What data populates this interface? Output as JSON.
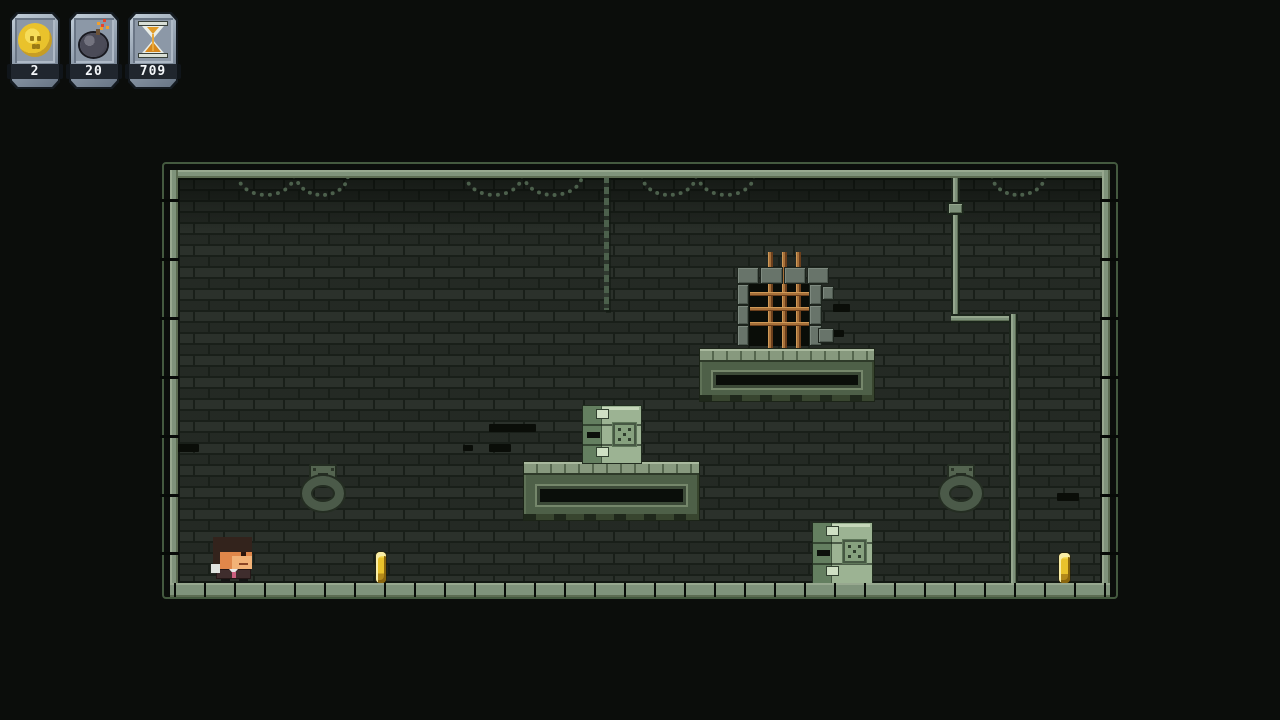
{
  "hud": {
    "counters": [
      {
        "id": "coins",
        "icon": "coin-icon",
        "value": "2"
      },
      {
        "id": "bombs",
        "icon": "bomb-icon",
        "value": "20"
      },
      {
        "id": "timer",
        "icon": "hourglass-icon",
        "value": "709"
      }
    ]
  },
  "colors": {
    "frame-green": "#44593f",
    "band-green": "#7f937b",
    "brick": "#262c26",
    "mortar": "#191f19",
    "platform-green": "#4e6048",
    "tile-green": "#87997e",
    "crate-green": "#9cb393",
    "bar-orange": "#a8713a",
    "coin-gold": "#e9c22c",
    "hud-strip": "#20262e",
    "hud-face": "#95a2b1",
    "spark-red": "#e8452a",
    "sand-orange": "#d6871c"
  },
  "entities": {
    "player": [
      213,
      537,
      40,
      46
    ],
    "coins": [
      [
        376,
        552,
        10,
        31
      ],
      [
        1059,
        553,
        11,
        30
      ]
    ],
    "platforms": [
      [
        700,
        349,
        174,
        52
      ],
      [
        524,
        462,
        175,
        58
      ]
    ],
    "crates": [
      [
        583,
        406,
        58,
        57
      ],
      [
        813,
        523,
        59,
        60
      ]
    ],
    "rings": [
      [
        301,
        462,
        44,
        50
      ],
      [
        939,
        462,
        44,
        50
      ]
    ],
    "window": [
      736,
      252,
      96,
      98
    ],
    "pipe": {
      "v1": [
        951,
        178,
        9,
        140
      ],
      "coupling": [
        947,
        202,
        17,
        13
      ],
      "elbow": [
        951,
        314,
        67,
        9
      ],
      "v2": [
        1009,
        314,
        9,
        269
      ]
    }
  },
  "decals": {
    "swags": [
      [
        236,
        175,
        60
      ],
      [
        294,
        175,
        56
      ],
      [
        464,
        175,
        60
      ],
      [
        522,
        175,
        62
      ],
      [
        640,
        175,
        58
      ],
      [
        696,
        175,
        60
      ],
      [
        990,
        175,
        57
      ]
    ],
    "vertical_chain": [
      604,
      176,
      134
    ],
    "dark_bricks": [
      [
        177,
        444,
        22,
        8
      ],
      [
        463,
        445,
        10,
        6
      ],
      [
        489,
        444,
        22,
        8
      ],
      [
        489,
        424,
        47,
        8
      ],
      [
        833,
        304,
        17,
        8
      ],
      [
        824,
        330,
        20,
        7
      ],
      [
        1057,
        493,
        22,
        8
      ]
    ],
    "bottom_ticks": {
      "start": 174,
      "step": 30,
      "count": 32,
      "y": 583
    },
    "side_ticks": [
      199,
      258,
      317,
      376,
      435,
      494,
      552
    ]
  }
}
